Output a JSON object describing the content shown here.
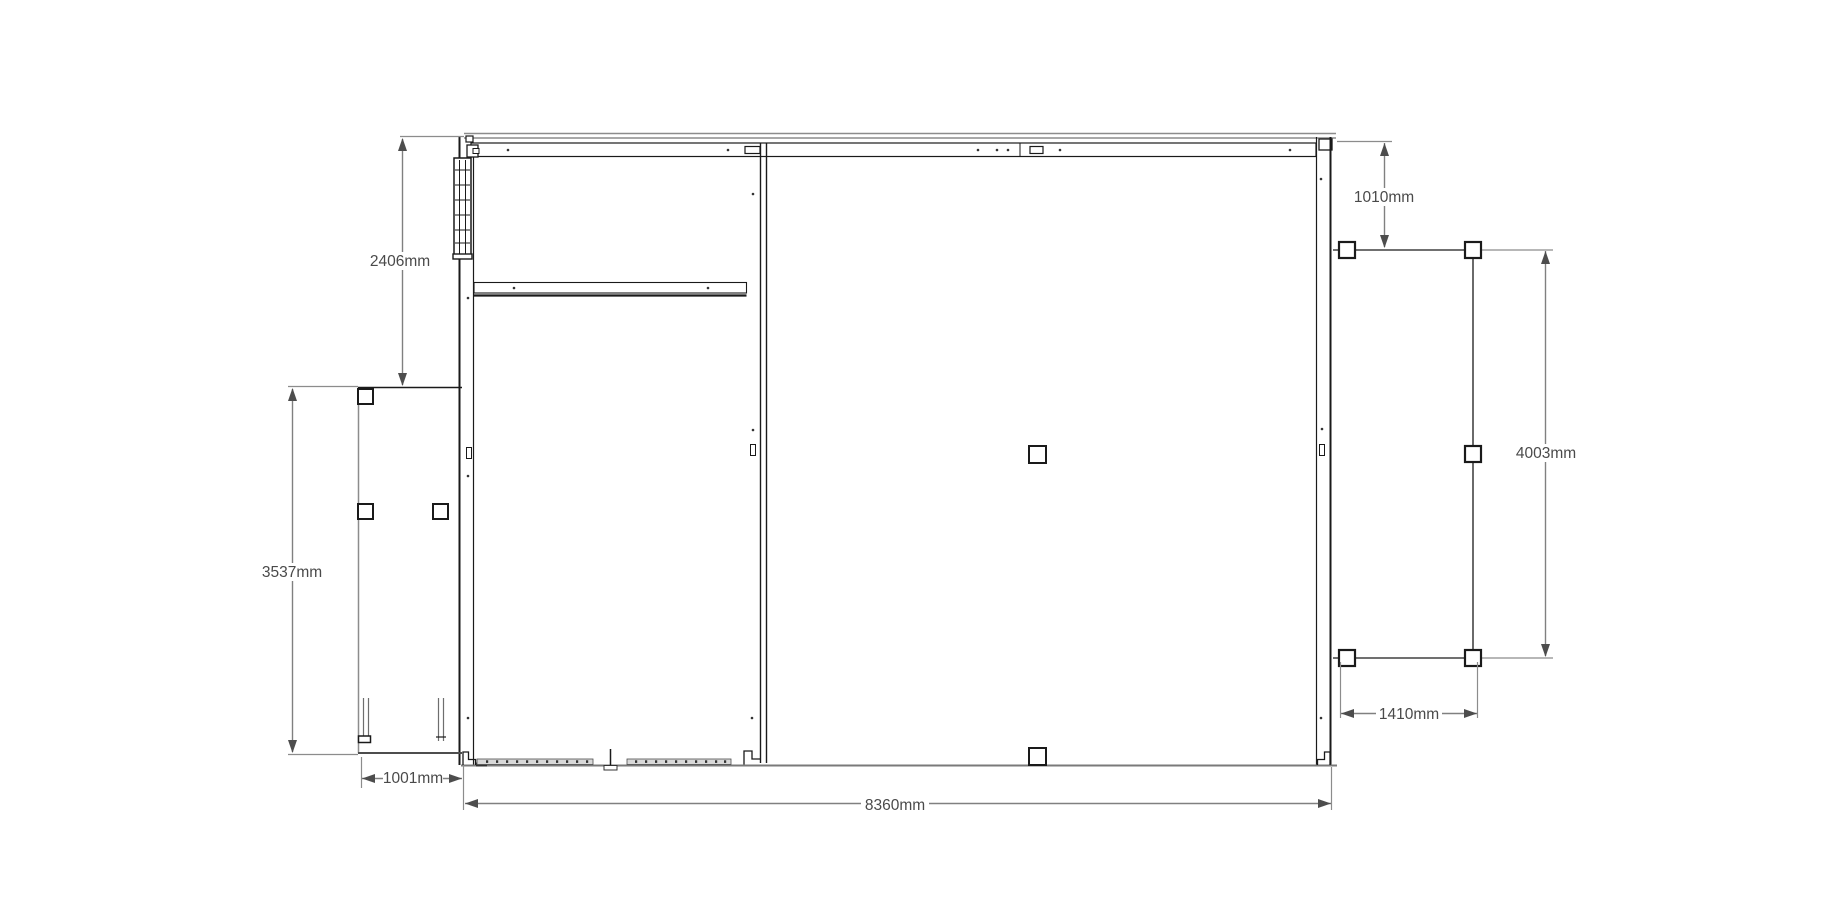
{
  "drawing": {
    "kind": "structure-floor-plan",
    "units": "mm",
    "background": "#ffffff",
    "colors": {
      "structure_line": "#1a1a1a",
      "secondary_line": "#8c8c8c",
      "dimension_line": "#808080",
      "dimension_text": "#4a4a4a",
      "arrowhead": "#4d4d4d",
      "sill_fill": "#d9d9d9"
    },
    "dimensions": {
      "left_upper_height": {
        "label": "2406mm",
        "orientation": "vertical"
      },
      "left_structure_height": {
        "label": "3537mm",
        "orientation": "vertical"
      },
      "left_structure_width": {
        "label": "1001mm",
        "orientation": "horizontal"
      },
      "main_bottom_width": {
        "label": "8360mm",
        "orientation": "horizontal"
      },
      "right_top_offset": {
        "label": "1010mm",
        "orientation": "vertical"
      },
      "right_structure_height": {
        "label": "4003mm",
        "orientation": "vertical"
      },
      "right_structure_width": {
        "label": "1410mm",
        "orientation": "horizontal"
      }
    }
  }
}
